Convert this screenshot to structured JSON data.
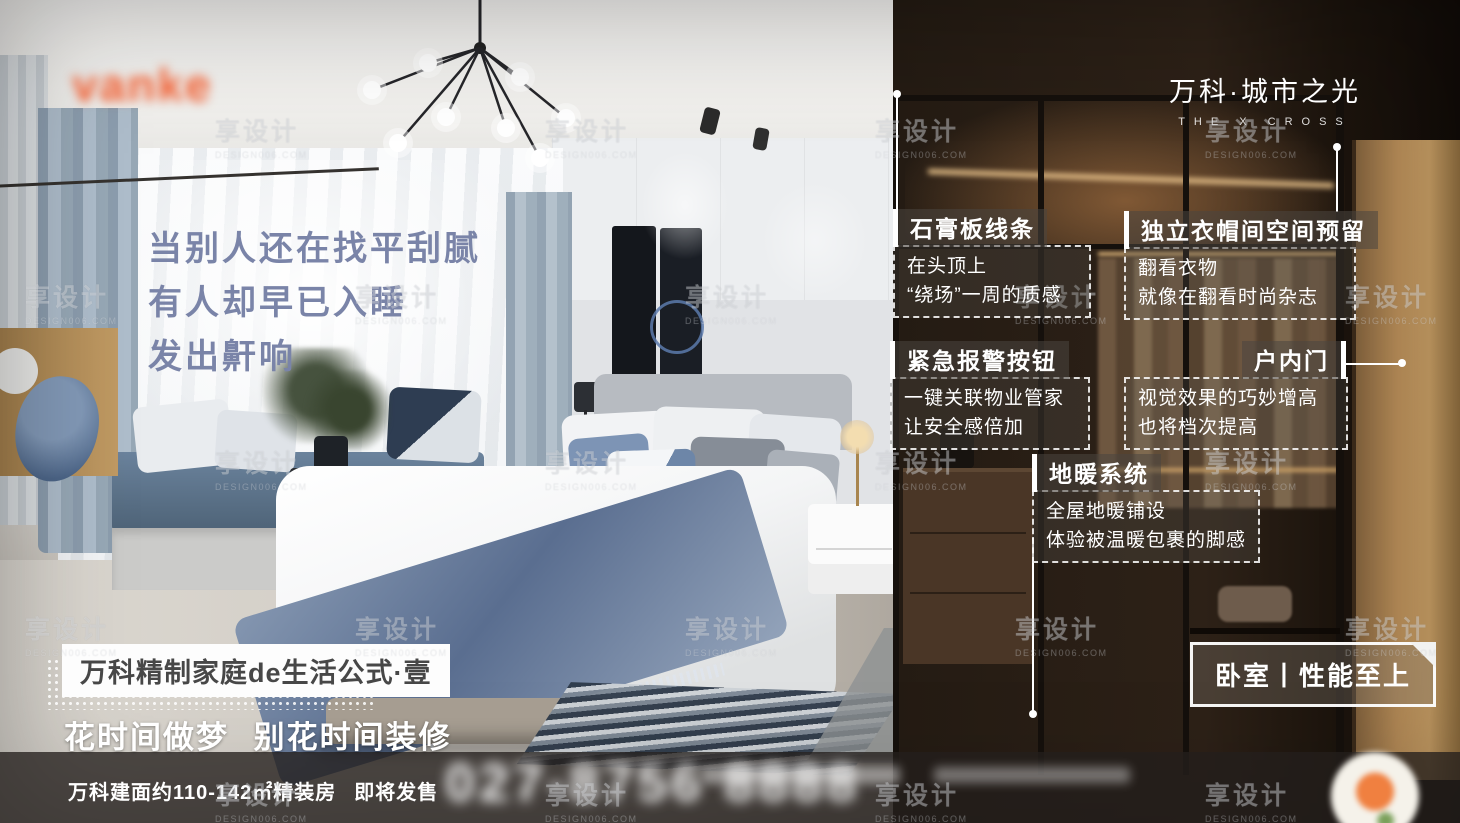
{
  "brand": {
    "logo": "vanke",
    "name": "万科·城市之光",
    "sub": "THE X CROSS"
  },
  "headline": {
    "lines": [
      "当别人还在找平刮腻",
      "有人却早已入睡",
      "发出鼾响"
    ]
  },
  "callouts": [
    {
      "title": "石膏板线条",
      "lines": [
        "在头顶上",
        "“绕场”一周的质感"
      ]
    },
    {
      "title": "独立衣帽间空间预留",
      "lines": [
        "翻看衣物",
        "就像在翻看时尚杂志"
      ]
    },
    {
      "title": "紧急报警按钮",
      "lines": [
        "一键关联物业管家",
        "让安全感倍加"
      ]
    },
    {
      "title": "户内门",
      "lines": [
        "视觉效果的巧妙增高",
        "也将档次提高"
      ]
    },
    {
      "title": "地暖系统",
      "lines": [
        "全屋地暖铺设",
        "体验被温暖包裹的脚感"
      ]
    }
  ],
  "slogan": {
    "formula": "万科精制家庭de生活公式·壹",
    "tagline": "花时间做梦 别花时间装修"
  },
  "badge": {
    "label": "卧室丨性能至上"
  },
  "footer": {
    "area": "万科建面约110-142㎡精装房",
    "status": "即将发售",
    "phone": "027-8756 8888"
  },
  "watermark": {
    "text": "享设计",
    "sub": "DESIGN006.COM"
  },
  "colors": {
    "accent_orange": "#f15b2d",
    "headline_blue": "#7a84a8",
    "callout_white": "#ffffff",
    "wood_amber": "#caa066"
  }
}
